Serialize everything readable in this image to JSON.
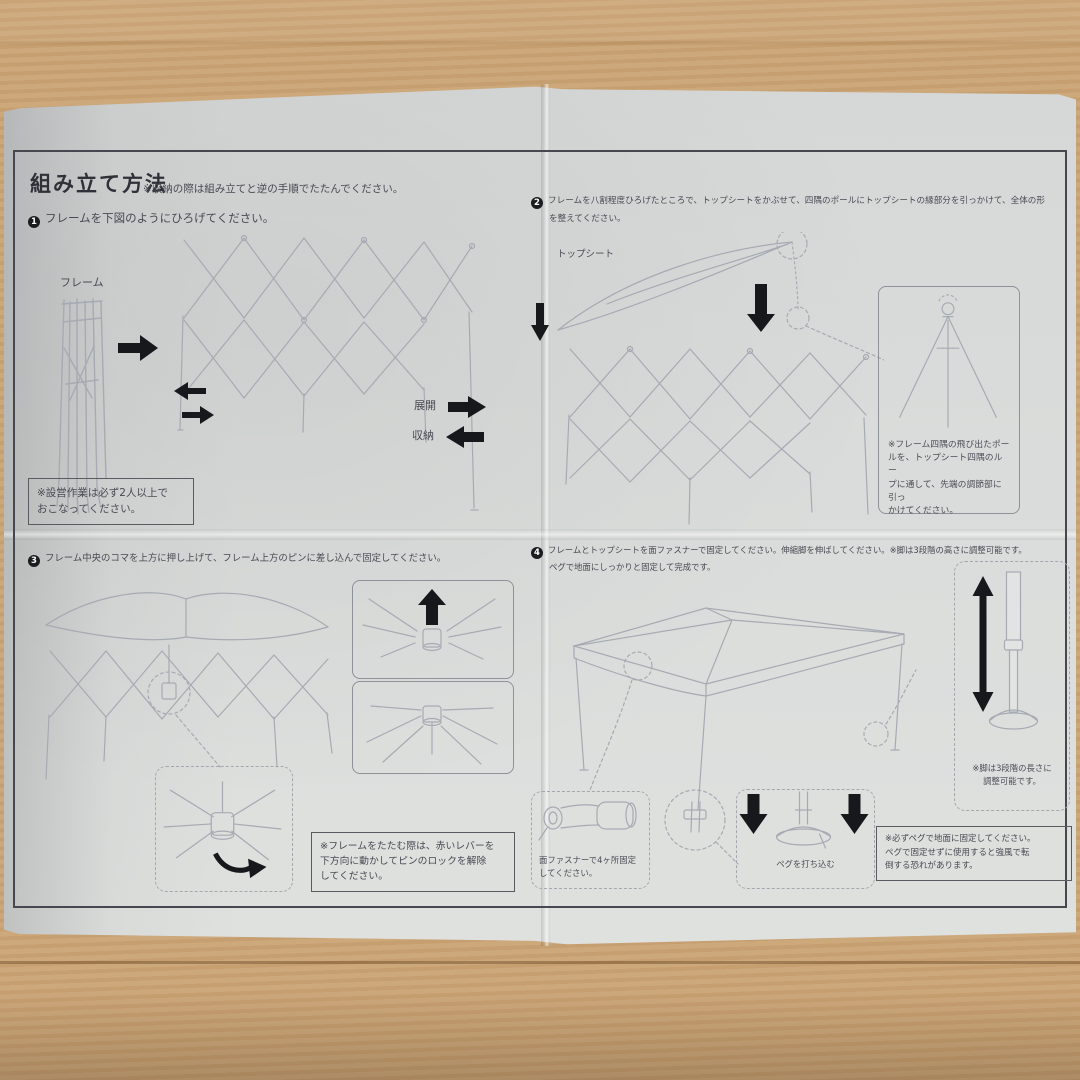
{
  "colors": {
    "paper": "#dadcdb",
    "wood": "#c79e6d",
    "ink": "#474a52",
    "sketch": "#a6aab2",
    "arrow_black": "#17181b"
  },
  "header": {
    "title": "組み立て方法",
    "note": "※収納の際は組み立てと逆の手順でたたんでください。"
  },
  "steps": {
    "step1": {
      "num": "1",
      "text": "フレームを下図のようにひろげてください。",
      "frame_label": "フレーム",
      "expand_label": "展開",
      "store_label": "収納",
      "note_lines": [
        "※設営作業は必ず2人以上で",
        "おこなってください。"
      ]
    },
    "step2": {
      "num": "2",
      "text_lines": [
        "フレームを八割程度ひろげたところで、トップシートをかぶせて、四隅のポールにトップシートの縁部分を引っかけて、全体の形",
        "を整えてください。"
      ],
      "topsheet_label": "トップシート",
      "corner_note_lines": [
        "※フレーム四隅の飛び出たポー",
        "ルを、トップシート四隅のルー",
        "プに通して、先端の調節部に引っ",
        "かけてください。"
      ]
    },
    "step3": {
      "num": "3",
      "text": "フレーム中央のコマを上方に押し上げて、フレーム上方のピンに差し込んで固定してください。",
      "note_lines": [
        "※フレームをたたむ際は、赤いレバーを",
        "下方向に動かしてピンのロックを解除",
        "してください。"
      ]
    },
    "step4": {
      "num": "4",
      "text_lines": [
        "フレームとトップシートを面ファスナーで固定してください。伸縮脚を伸ばしてください。※脚は3段階の高さに調整可能です。",
        "ペグで地面にしっかりと固定して完成です。"
      ],
      "leg_note_lines": [
        "※脚は3段階の長さに",
        "調整可能です。"
      ],
      "velcro_lines": [
        "面ファスナーで4ヶ所固定",
        "してください。"
      ],
      "peg_label": "ペグを打ち込む",
      "warning_lines": [
        "※必ずペグで地面に固定してください。",
        "ペグで固定せずに使用すると強風で転",
        "倒する恐れがあります。"
      ]
    }
  }
}
